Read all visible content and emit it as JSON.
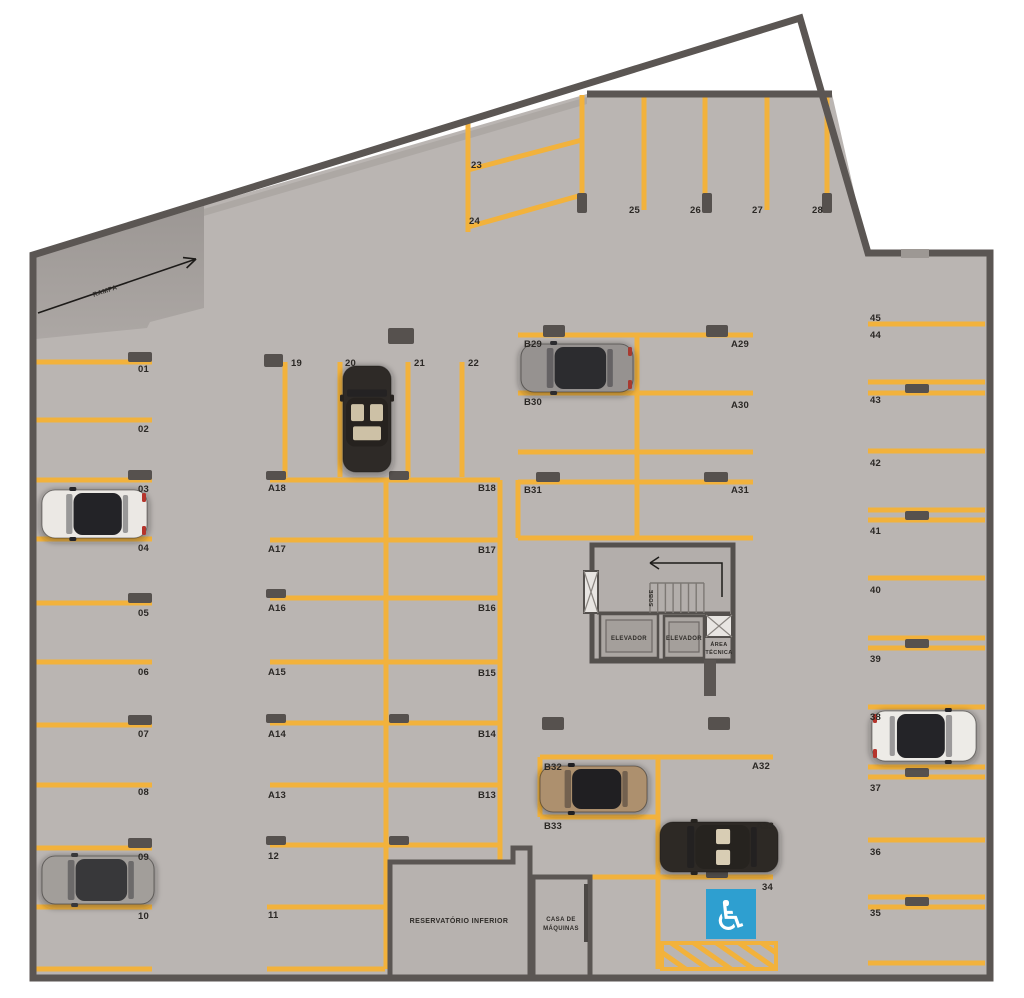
{
  "texts": {
    "ramp": "RAMPA",
    "reservoir": "RESERVATÓRIO INFERIOR",
    "machine_room_line1": "CASA DE",
    "machine_room_line2": "MÁQUINAS",
    "elevator_left": "ELEVADOR",
    "elevator_right": "ELEVADOR",
    "technical_line1": "ÁREA",
    "technical_line2": "TÉCNICA",
    "stairs_direction": "SOBE",
    "accessible_icon": "♿"
  },
  "colors": {
    "floor": "#bab5b2",
    "room_fill": "#b7b2af",
    "wall": "#5b5653",
    "line": "#f2b23c",
    "stop": "#56514e",
    "accessible_blue": "#2e9fd0",
    "text": "#2b2825"
  },
  "geometry": {
    "lines": [
      [
        33,
        362,
        152,
        362
      ],
      [
        33,
        420,
        152,
        420
      ],
      [
        33,
        480,
        152,
        480
      ],
      [
        33,
        539,
        152,
        539
      ],
      [
        33,
        603,
        152,
        603
      ],
      [
        33,
        662,
        152,
        662
      ],
      [
        33,
        725,
        152,
        725
      ],
      [
        33,
        785,
        152,
        785
      ],
      [
        33,
        848,
        152,
        848
      ],
      [
        33,
        907,
        152,
        907
      ],
      [
        35,
        969,
        152,
        969
      ],
      [
        270,
        480,
        500,
        480
      ],
      [
        270,
        540,
        500,
        540
      ],
      [
        270,
        598,
        500,
        598
      ],
      [
        270,
        662,
        500,
        662
      ],
      [
        270,
        723,
        500,
        723
      ],
      [
        270,
        785,
        500,
        785
      ],
      [
        270,
        845,
        500,
        845
      ],
      [
        267,
        907,
        385,
        907
      ],
      [
        267,
        969,
        385,
        969
      ],
      [
        386,
        480,
        386,
        969
      ],
      [
        500,
        480,
        500,
        862
      ],
      [
        285,
        362,
        285,
        477
      ],
      [
        340,
        362,
        340,
        477
      ],
      [
        408,
        362,
        408,
        477
      ],
      [
        462,
        362,
        462,
        477
      ],
      [
        468,
        123,
        468,
        232
      ],
      [
        582,
        95,
        582,
        213
      ],
      [
        644,
        97,
        644,
        210
      ],
      [
        705,
        97,
        705,
        210
      ],
      [
        767,
        97,
        767,
        210
      ],
      [
        827,
        97,
        827,
        213
      ],
      [
        468,
        170,
        582,
        140
      ],
      [
        468,
        227,
        582,
        195
      ],
      [
        518,
        335,
        753,
        335
      ],
      [
        518,
        393,
        753,
        393
      ],
      [
        518,
        452,
        753,
        452
      ],
      [
        518,
        482,
        753,
        482
      ],
      [
        518,
        538,
        753,
        538
      ],
      [
        518,
        480,
        518,
        538
      ],
      [
        637,
        335,
        637,
        538
      ],
      [
        540,
        757,
        773,
        757
      ],
      [
        540,
        817,
        658,
        817
      ],
      [
        587,
        877,
        773,
        877
      ],
      [
        540,
        757,
        540,
        817
      ],
      [
        658,
        757,
        658,
        969
      ],
      [
        868,
        324,
        985,
        324
      ],
      [
        868,
        451,
        985,
        451
      ],
      [
        868,
        578,
        985,
        578
      ],
      [
        868,
        707,
        985,
        707
      ],
      [
        868,
        840,
        985,
        840
      ],
      [
        868,
        963,
        985,
        963
      ],
      [
        868,
        382,
        985,
        382
      ],
      [
        868,
        393,
        985,
        393
      ],
      [
        868,
        510,
        985,
        510
      ],
      [
        868,
        520,
        985,
        520
      ],
      [
        868,
        638,
        985,
        638
      ],
      [
        868,
        648,
        985,
        648
      ],
      [
        868,
        767,
        985,
        767
      ],
      [
        868,
        777,
        985,
        777
      ],
      [
        868,
        897,
        985,
        897
      ],
      [
        868,
        907,
        985,
        907
      ]
    ],
    "stops": [
      [
        128,
        352,
        24,
        10
      ],
      [
        128,
        470,
        24,
        10
      ],
      [
        128,
        593,
        24,
        10
      ],
      [
        128,
        715,
        24,
        10
      ],
      [
        128,
        838,
        24,
        10
      ],
      [
        266,
        471,
        20,
        9
      ],
      [
        266,
        589,
        20,
        9
      ],
      [
        266,
        714,
        20,
        9
      ],
      [
        266,
        836,
        20,
        9
      ],
      [
        389,
        471,
        20,
        9
      ],
      [
        389,
        714,
        20,
        9
      ],
      [
        389,
        836,
        20,
        9
      ],
      [
        388,
        328,
        26,
        16
      ],
      [
        264,
        354,
        19,
        13
      ],
      [
        543,
        325,
        22,
        12
      ],
      [
        706,
        325,
        22,
        12
      ],
      [
        536,
        472,
        24,
        10
      ],
      [
        704,
        472,
        24,
        10
      ],
      [
        542,
        717,
        22,
        13
      ],
      [
        708,
        717,
        22,
        13
      ],
      [
        706,
        867,
        22,
        11
      ],
      [
        905,
        384,
        24,
        9
      ],
      [
        905,
        511,
        24,
        9
      ],
      [
        905,
        639,
        24,
        9
      ],
      [
        905,
        768,
        24,
        9
      ],
      [
        905,
        897,
        24,
        9
      ],
      [
        577,
        193,
        10,
        20
      ],
      [
        702,
        193,
        10,
        20
      ],
      [
        822,
        193,
        10,
        20
      ],
      [
        392,
        862,
        20,
        12
      ]
    ]
  },
  "spot_labels": [
    {
      "t": "01",
      "x": 149,
      "y": 372,
      "a": "end"
    },
    {
      "t": "02",
      "x": 149,
      "y": 432,
      "a": "end"
    },
    {
      "t": "03",
      "x": 149,
      "y": 492,
      "a": "end"
    },
    {
      "t": "04",
      "x": 149,
      "y": 551,
      "a": "end"
    },
    {
      "t": "05",
      "x": 149,
      "y": 616,
      "a": "end"
    },
    {
      "t": "06",
      "x": 149,
      "y": 675,
      "a": "end"
    },
    {
      "t": "07",
      "x": 149,
      "y": 737,
      "a": "end"
    },
    {
      "t": "08",
      "x": 149,
      "y": 795,
      "a": "end"
    },
    {
      "t": "09",
      "x": 149,
      "y": 860,
      "a": "end"
    },
    {
      "t": "10",
      "x": 149,
      "y": 919,
      "a": "end"
    },
    {
      "t": "A18",
      "x": 268,
      "y": 491,
      "a": "start"
    },
    {
      "t": "A17",
      "x": 268,
      "y": 552,
      "a": "start"
    },
    {
      "t": "A16",
      "x": 268,
      "y": 611,
      "a": "start"
    },
    {
      "t": "A15",
      "x": 268,
      "y": 675,
      "a": "start"
    },
    {
      "t": "A14",
      "x": 268,
      "y": 737,
      "a": "start"
    },
    {
      "t": "A13",
      "x": 268,
      "y": 798,
      "a": "start"
    },
    {
      "t": "12",
      "x": 268,
      "y": 859,
      "a": "start"
    },
    {
      "t": "11",
      "x": 268,
      "y": 918,
      "a": "start"
    },
    {
      "t": "B18",
      "x": 496,
      "y": 491,
      "a": "end"
    },
    {
      "t": "B17",
      "x": 496,
      "y": 553,
      "a": "end"
    },
    {
      "t": "B16",
      "x": 496,
      "y": 611,
      "a": "end"
    },
    {
      "t": "B15",
      "x": 496,
      "y": 676,
      "a": "end"
    },
    {
      "t": "B14",
      "x": 496,
      "y": 737,
      "a": "end"
    },
    {
      "t": "B13",
      "x": 496,
      "y": 798,
      "a": "end"
    },
    {
      "t": "19",
      "x": 291,
      "y": 366,
      "a": "start"
    },
    {
      "t": "20",
      "x": 345,
      "y": 366,
      "a": "start"
    },
    {
      "t": "21",
      "x": 414,
      "y": 366,
      "a": "start"
    },
    {
      "t": "22",
      "x": 468,
      "y": 366,
      "a": "start"
    },
    {
      "t": "23",
      "x": 471,
      "y": 168,
      "a": "start"
    },
    {
      "t": "24",
      "x": 469,
      "y": 224,
      "a": "start"
    },
    {
      "t": "25",
      "x": 640,
      "y": 213,
      "a": "end"
    },
    {
      "t": "26",
      "x": 701,
      "y": 213,
      "a": "end"
    },
    {
      "t": "27",
      "x": 763,
      "y": 213,
      "a": "end"
    },
    {
      "t": "28",
      "x": 823,
      "y": 213,
      "a": "end"
    },
    {
      "t": "B29",
      "x": 524,
      "y": 347,
      "a": "start"
    },
    {
      "t": "A29",
      "x": 749,
      "y": 347,
      "a": "end"
    },
    {
      "t": "B30",
      "x": 524,
      "y": 405,
      "a": "start"
    },
    {
      "t": "A30",
      "x": 749,
      "y": 408,
      "a": "end"
    },
    {
      "t": "B31",
      "x": 524,
      "y": 493,
      "a": "start"
    },
    {
      "t": "A31",
      "x": 749,
      "y": 493,
      "a": "end"
    },
    {
      "t": "B32",
      "x": 544,
      "y": 770,
      "a": "start"
    },
    {
      "t": "A32",
      "x": 770,
      "y": 769,
      "a": "end"
    },
    {
      "t": "B33",
      "x": 544,
      "y": 829,
      "a": "start"
    },
    {
      "t": "A33",
      "x": 774,
      "y": 829,
      "a": "end"
    },
    {
      "t": "34",
      "x": 773,
      "y": 890,
      "a": "end"
    },
    {
      "t": "45",
      "x": 870,
      "y": 321,
      "a": "start"
    },
    {
      "t": "44",
      "x": 870,
      "y": 338,
      "a": "start"
    },
    {
      "t": "43",
      "x": 870,
      "y": 403,
      "a": "start"
    },
    {
      "t": "42",
      "x": 870,
      "y": 466,
      "a": "start"
    },
    {
      "t": "41",
      "x": 870,
      "y": 534,
      "a": "start"
    },
    {
      "t": "40",
      "x": 870,
      "y": 593,
      "a": "start"
    },
    {
      "t": "39",
      "x": 870,
      "y": 662,
      "a": "start"
    },
    {
      "t": "38",
      "x": 870,
      "y": 720,
      "a": "start"
    },
    {
      "t": "37",
      "x": 870,
      "y": 791,
      "a": "start"
    },
    {
      "t": "36",
      "x": 870,
      "y": 855,
      "a": "start"
    },
    {
      "t": "35",
      "x": 870,
      "y": 916,
      "a": "start"
    }
  ],
  "cars": [
    {
      "x": 42,
      "y": 490,
      "w": 105,
      "h": 48,
      "dir": "h",
      "front": "left",
      "body": "#ebe8e4",
      "roof": "#232327",
      "accent": "#b5342c"
    },
    {
      "x": 42,
      "y": 856,
      "w": 112,
      "h": 48,
      "dir": "h",
      "front": "left",
      "body": "#a29e9a",
      "roof": "#38383a"
    },
    {
      "x": 343,
      "y": 366,
      "w": 48,
      "h": 106,
      "dir": "v",
      "front": "up",
      "body": "#2e2a27",
      "roof": "#26221f",
      "seats": "#cdc1a6"
    },
    {
      "x": 521,
      "y": 344,
      "w": 112,
      "h": 48,
      "dir": "h",
      "front": "left",
      "body": "#969290",
      "roof": "#2c2c2f",
      "accent": "#a83a30"
    },
    {
      "x": 540,
      "y": 766,
      "w": 107,
      "h": 46,
      "dir": "h",
      "front": "left",
      "body": "#ad906e",
      "roof": "#201f22"
    },
    {
      "x": 660,
      "y": 822,
      "w": 118,
      "h": 50,
      "dir": "h",
      "front": "left",
      "body": "#2d2925",
      "roof": "#26231f",
      "seats": "#d8cdb4"
    },
    {
      "x": 872,
      "y": 711,
      "w": 104,
      "h": 50,
      "dir": "h",
      "front": "right",
      "body": "#edebe7",
      "roof": "#242428",
      "accent": "#b5342c"
    }
  ]
}
